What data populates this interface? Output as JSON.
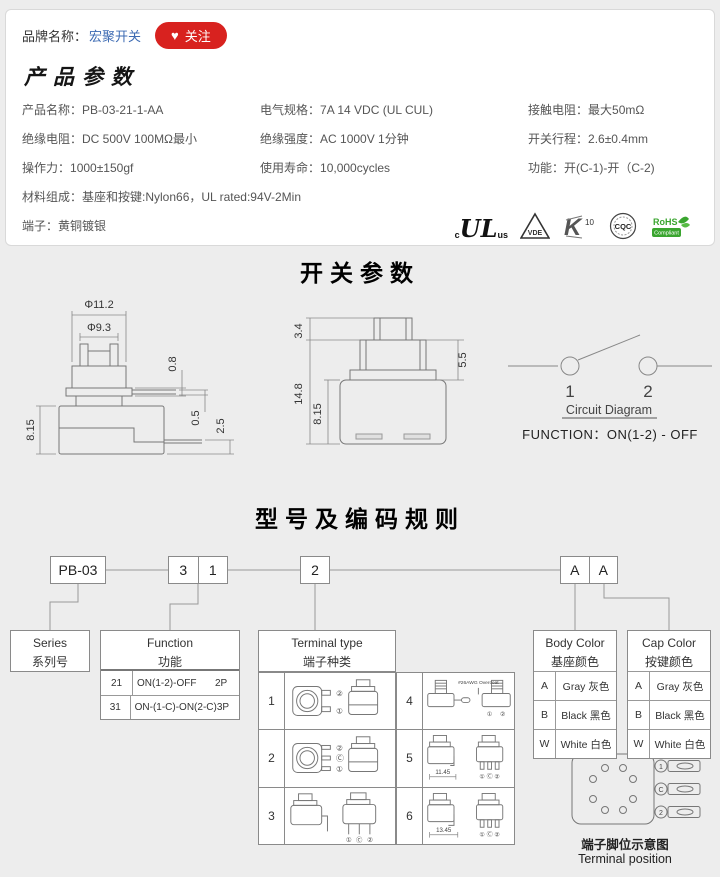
{
  "header": {
    "brand_label": "品牌名称：",
    "brand_name": "宏聚开关",
    "follow_icon": "♥",
    "follow_label": "关注"
  },
  "product_params": {
    "title": "产品参数",
    "grid": [
      {
        "label": "产品名称：",
        "value": "PB-03-21-1-AA"
      },
      {
        "label": "电气规格：",
        "value": "7A 14 VDC (UL CUL)"
      },
      {
        "label": "接触电阻：",
        "value": "最大50mΩ"
      },
      {
        "label": "绝缘电阻：",
        "value": "DC 500V 100MΩ最小"
      },
      {
        "label": "绝缘强度：",
        "value": "AC 1000V 1分钟"
      },
      {
        "label": "开关行程：",
        "value": "2.6±0.4mm"
      },
      {
        "label": "操作力：",
        "value": "1000±150gf"
      },
      {
        "label": "使用寿命：",
        "value": "10,000cycles"
      },
      {
        "label": "功能：",
        "value": "开(C-1)-开（C-2)"
      }
    ],
    "material_label": "材料组成：",
    "material_value": "基座和按键:Nylon66，UL rated:94V-2Min",
    "terminal_label": "端子：",
    "terminal_value": "黄铜镀银",
    "certs": {
      "ul_c": "c",
      "ul": "UL",
      "ul_us": "us",
      "vde": "VDE",
      "k": "K",
      "k10": "10",
      "cqc": "CQC",
      "rohs": "RoHS",
      "rohs_sub": "Compliant"
    }
  },
  "switch_params": {
    "title": "开关参数",
    "side_view": {
      "dia_outer": "Φ11.2",
      "dia_inner": "Φ9.3",
      "dim_cap": "0.8",
      "dim_plate": "0.5",
      "dim_pin": "2.5",
      "dim_body": "8.15"
    },
    "front_view": {
      "dim_top": "3.4",
      "dim_neck": "5.5",
      "dim_total": "14.8",
      "dim_body": "8.15"
    },
    "circuit": {
      "pin1": "1",
      "pin2": "2",
      "caption": "Circuit Diagram",
      "function_text": "FUNCTION：ON(1-2) - OFF"
    }
  },
  "coding": {
    "title": "型号及编码规则",
    "boxes": {
      "series": "PB-03",
      "func_a": "3",
      "func_b": "1",
      "terminal": "2",
      "body": "A",
      "cap": "A"
    },
    "series_table": {
      "en": "Series",
      "cn": "系列号"
    },
    "function_table": {
      "en": "Function",
      "cn": "功能",
      "rows": [
        {
          "code": "21",
          "desc": "ON(1-2)-OFF",
          "poles": "2P"
        },
        {
          "code": "31",
          "desc": "ON-(1-C)-ON(2-C)",
          "poles": "3P"
        }
      ]
    },
    "terminal_table": {
      "en": "Terminal type",
      "cn": "端子种类",
      "nums": [
        "1",
        "2",
        "3",
        "4",
        "5",
        "6"
      ],
      "wire_note": "#26AWG Overcoat",
      "dim5": "11.45",
      "dim6": "13.45",
      "l1": "①",
      "l2": "②",
      "lc": "Ⓒ"
    },
    "body_color_table": {
      "en": "Body Color",
      "cn": "基座颜色",
      "rows": [
        {
          "code": "A",
          "name": "Gray 灰色"
        },
        {
          "code": "B",
          "name": "Black 黑色"
        },
        {
          "code": "W",
          "name": "White 白色"
        }
      ]
    },
    "cap_color_table": {
      "en": "Cap Color",
      "cn": "按键颜色",
      "rows": [
        {
          "code": "A",
          "name": "Gray 灰色"
        },
        {
          "code": "B",
          "name": "Black 黑色"
        },
        {
          "code": "W",
          "name": "White 白色"
        }
      ]
    },
    "terminal_position": {
      "cn": "端子脚位示意图",
      "en": "Terminal position",
      "pins": [
        "1",
        "C",
        "2"
      ]
    }
  }
}
